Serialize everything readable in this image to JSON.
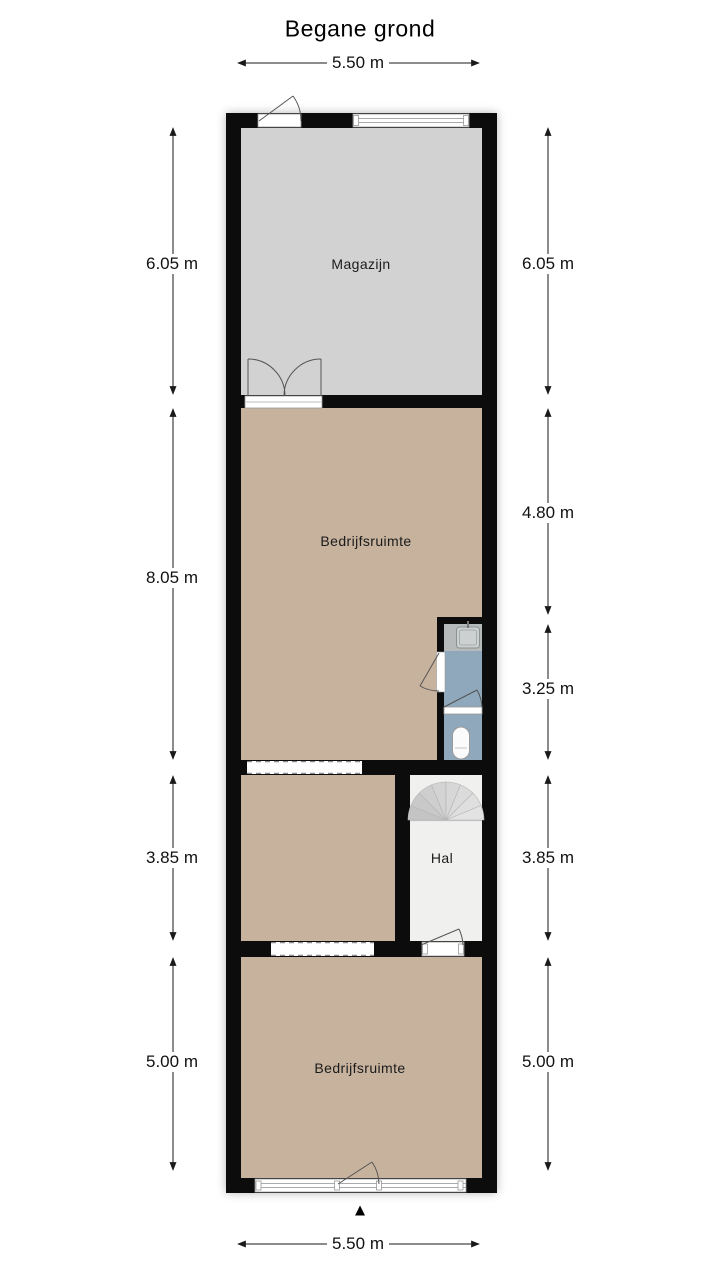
{
  "title": "Begane grond",
  "compass": {
    "north_symbol": "▲"
  },
  "rooms": {
    "magazijn": {
      "label": "Magazijn"
    },
    "bedrijfsruimte_top": {
      "label": "Bedrijfsruimte"
    },
    "hal": {
      "label": "Hal"
    },
    "bedrijfsruimte_bottom": {
      "label": "Bedrijfsruimte"
    }
  },
  "dimensions": {
    "top": {
      "label": "5.50 m"
    },
    "bottom": {
      "label": "5.50 m"
    },
    "left": [
      {
        "label": "6.05 m"
      },
      {
        "label": "8.05 m"
      },
      {
        "label": "3.85 m"
      },
      {
        "label": "5.00 m"
      }
    ],
    "right": [
      {
        "label": "6.05 m"
      },
      {
        "label": "4.80 m"
      },
      {
        "label": "3.25 m"
      },
      {
        "label": "3.85 m"
      },
      {
        "label": "5.00 m"
      }
    ]
  },
  "colors": {
    "wall": "#0c0c0c",
    "magazijn_floor": "#d2d2d2",
    "bedrijfsruimte_floor": "#c7b29d",
    "hal_floor": "#f0f0ee",
    "bathroom_floor": "#8fa8bb",
    "counter": "#b6babb"
  }
}
